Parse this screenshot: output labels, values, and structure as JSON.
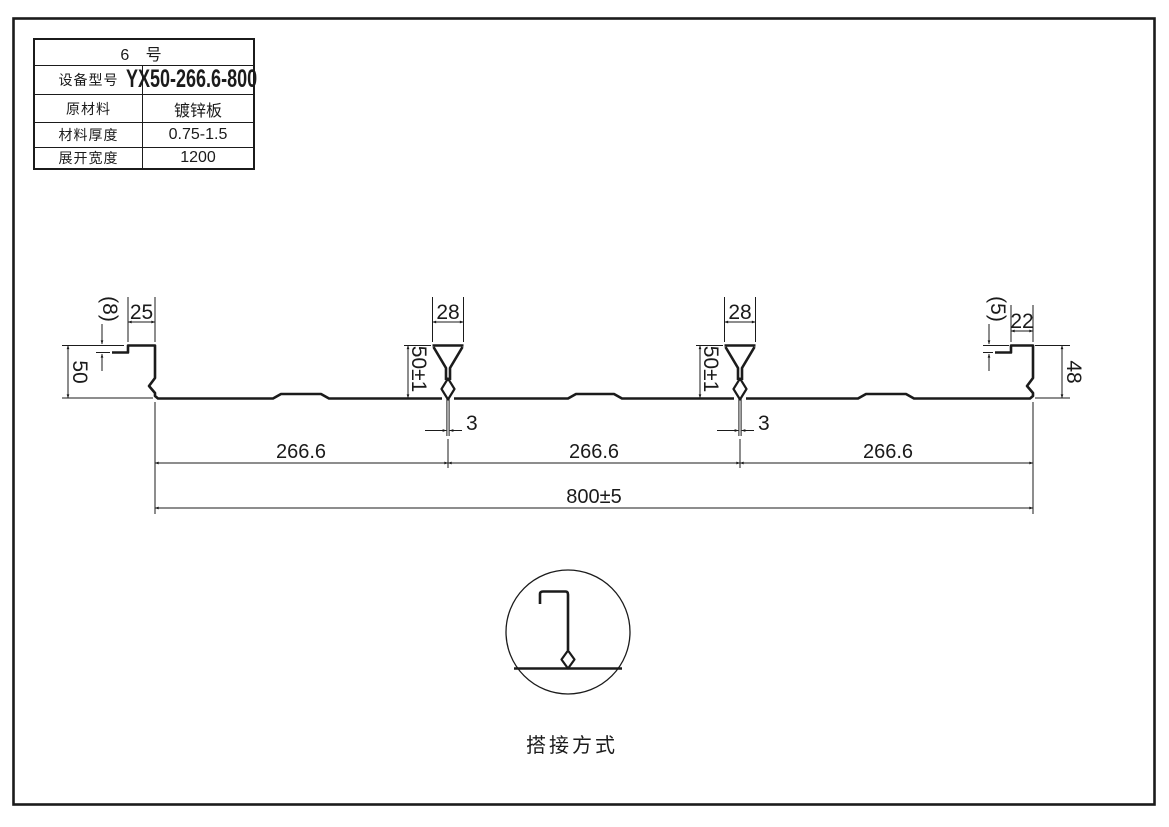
{
  "table": {
    "header": "6 号",
    "rows": [
      {
        "label": "设备型号",
        "value": "YX50-266.6-800"
      },
      {
        "label": "原材料",
        "value": "镀锌板"
      },
      {
        "label": "材料厚度",
        "value": "0.75-1.5"
      },
      {
        "label": "展开宽度",
        "value": "1200"
      }
    ]
  },
  "dims": {
    "left_lip_drop": "(8)",
    "left_top_flange_width": "25",
    "left_edge_height": "50",
    "rib_top_width": "28",
    "rib_height": "50±1",
    "rib_bottom_gap": "3",
    "right_lip_drop": "(5)",
    "right_top_flange_width": "22",
    "right_edge_height": "48",
    "module_width": "266.6",
    "overall_width": "800±5"
  },
  "detail": {
    "caption": "搭接方式"
  },
  "colors": {
    "ink": "#1b1b1b",
    "paper": "#ffffff"
  }
}
